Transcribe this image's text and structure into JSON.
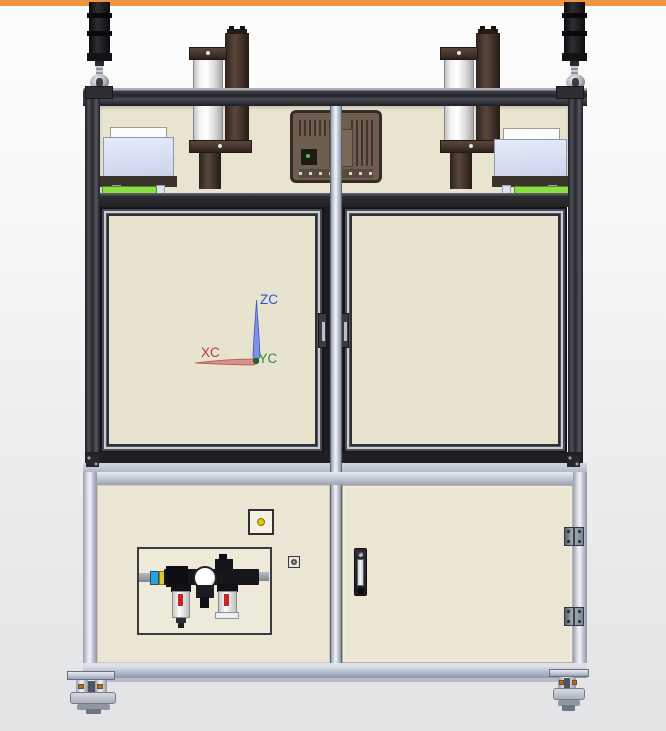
{
  "view": {
    "top_bar_color": "#EC9440",
    "background_top": "#FDFDFD",
    "background_bottom": "#E2E3E5"
  },
  "triad": {
    "z_label": "ZC",
    "x_label": "XC",
    "y_label": "YC",
    "z_color": "#2B4FD8",
    "x_color": "#C23434",
    "y_color": "#2E8F3A"
  },
  "machine": {
    "frame_color": "#2A2A30",
    "panel_color": "#E9E4D0",
    "aluminum_color": "#C6CDDA",
    "green_plate_color": "#8ADE44",
    "indicator_dot_color": "#DDC50F",
    "bowl_arrow_color": "#C32424",
    "components": {
      "left_tower": "signal-tower-light",
      "right_tower": "signal-tower-light",
      "left_cylinder": "pneumatic-cylinder-unit",
      "right_cylinder": "pneumatic-cylinder-unit",
      "hmi": "hmi-panel-rear",
      "frl": "air-filter-regulator-lubricator",
      "left_fixture": "fixture-box",
      "right_fixture": "fixture-box",
      "lower_right": "cabinet-door",
      "lower_left": "service-panel"
    }
  }
}
